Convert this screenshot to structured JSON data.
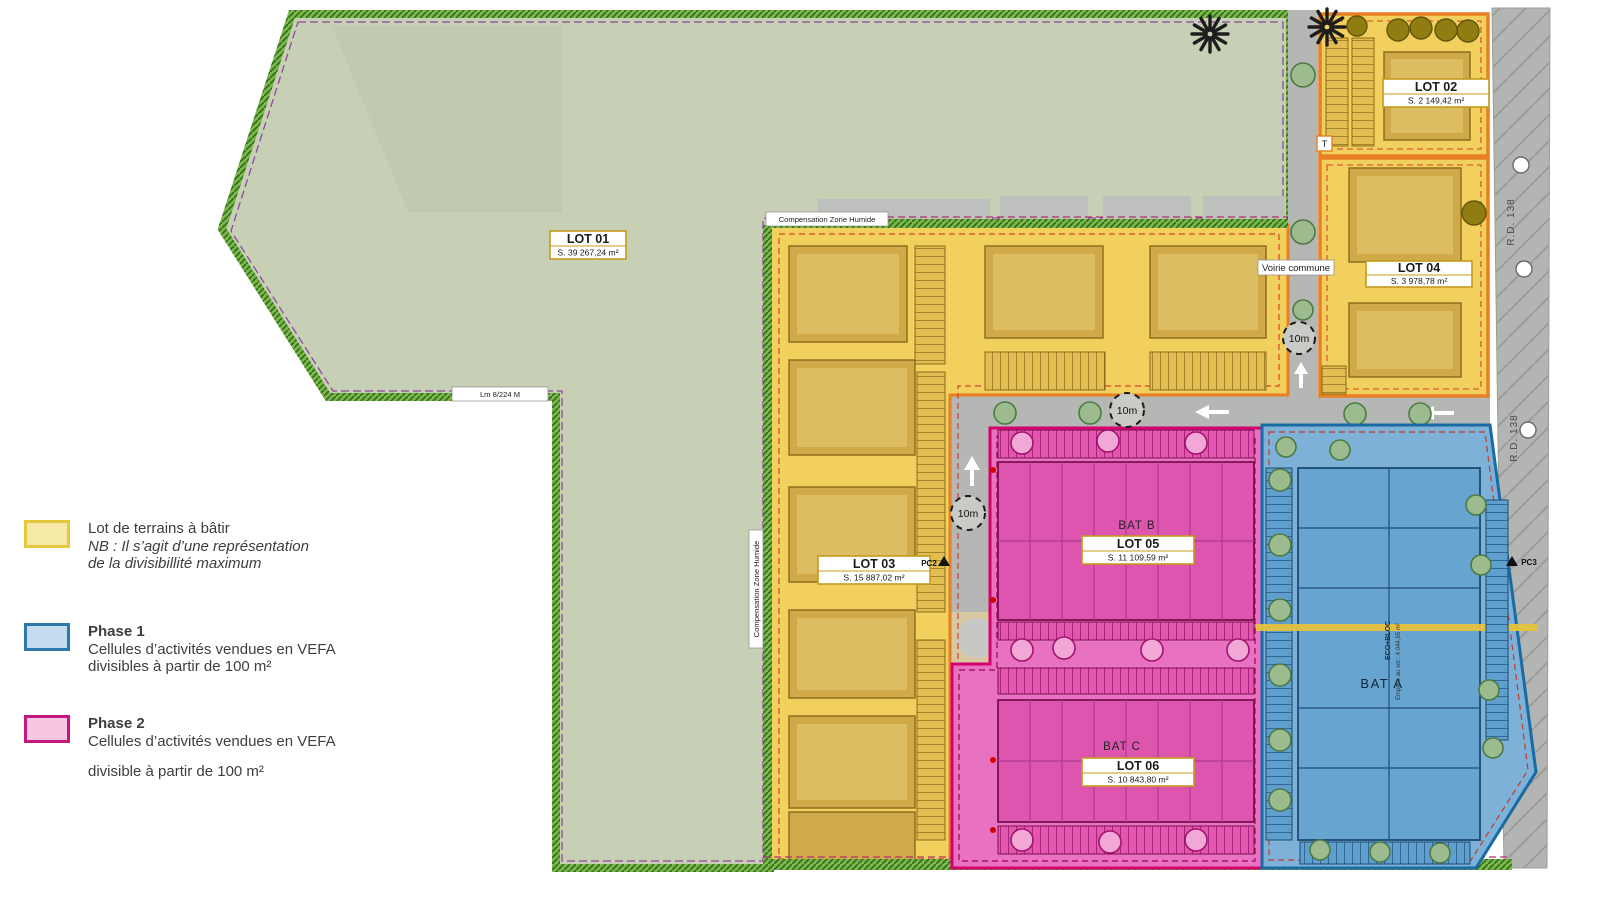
{
  "legend": {
    "terrain": {
      "title": "Lot de terrains à bâtir",
      "note1": "NB :  Il s’agit d’une représentation",
      "note2": "de la divisibillité maximum"
    },
    "phase1": {
      "title": "Phase 1",
      "line1": "Cellules d’activités vendues en VEFA",
      "line2": "divisibles à partir de 100 m²"
    },
    "phase2": {
      "title": "Phase 2",
      "line1": "Cellules d’activités vendues en VEFA",
      "line2": "divisible à partir de 100 m²"
    }
  },
  "lots": {
    "lot01": {
      "name": "LOT 01",
      "area": "S. 39 267,24 m²"
    },
    "lot02": {
      "name": "LOT 02",
      "area": "S. 2 149,42 m²"
    },
    "lot03": {
      "name": "LOT 03",
      "area": "S. 15 887,02 m²"
    },
    "lot04": {
      "name": "LOT 04",
      "area": "S. 3 978,78 m²"
    },
    "lot05": {
      "name": "LOT 05",
      "area": "S. 11 109,59 m²"
    },
    "lot06": {
      "name": "LOT 06",
      "area": "S. 10 843,80 m²"
    }
  },
  "buildings": {
    "bat_a": "BAT A",
    "bat_b": "BAT B",
    "bat_c": "BAT C",
    "eco_bloc": "ECO+BLOC",
    "emprise": "Emprise au sol : 4 044,95 m²"
  },
  "annotations": {
    "voirie": "Voirie commune",
    "compensation": "Compensation Zone Humide",
    "dist10": "10m",
    "rd138": "R.D. 138",
    "lim": "Lm 8/224 M",
    "pc2": "PC2",
    "pc3": "PC3",
    "t": "T"
  },
  "colors": {
    "terrain_lot": "#f0cf5f",
    "lot_border": "#e87f22",
    "phase1_fill": "#7fb1d7",
    "phase1_border": "#1a6aa5",
    "phase2_fill": "#e665bd",
    "phase2_border": "#d40070",
    "green_field": "#c7d0b5",
    "road": "#b4b7b3"
  }
}
